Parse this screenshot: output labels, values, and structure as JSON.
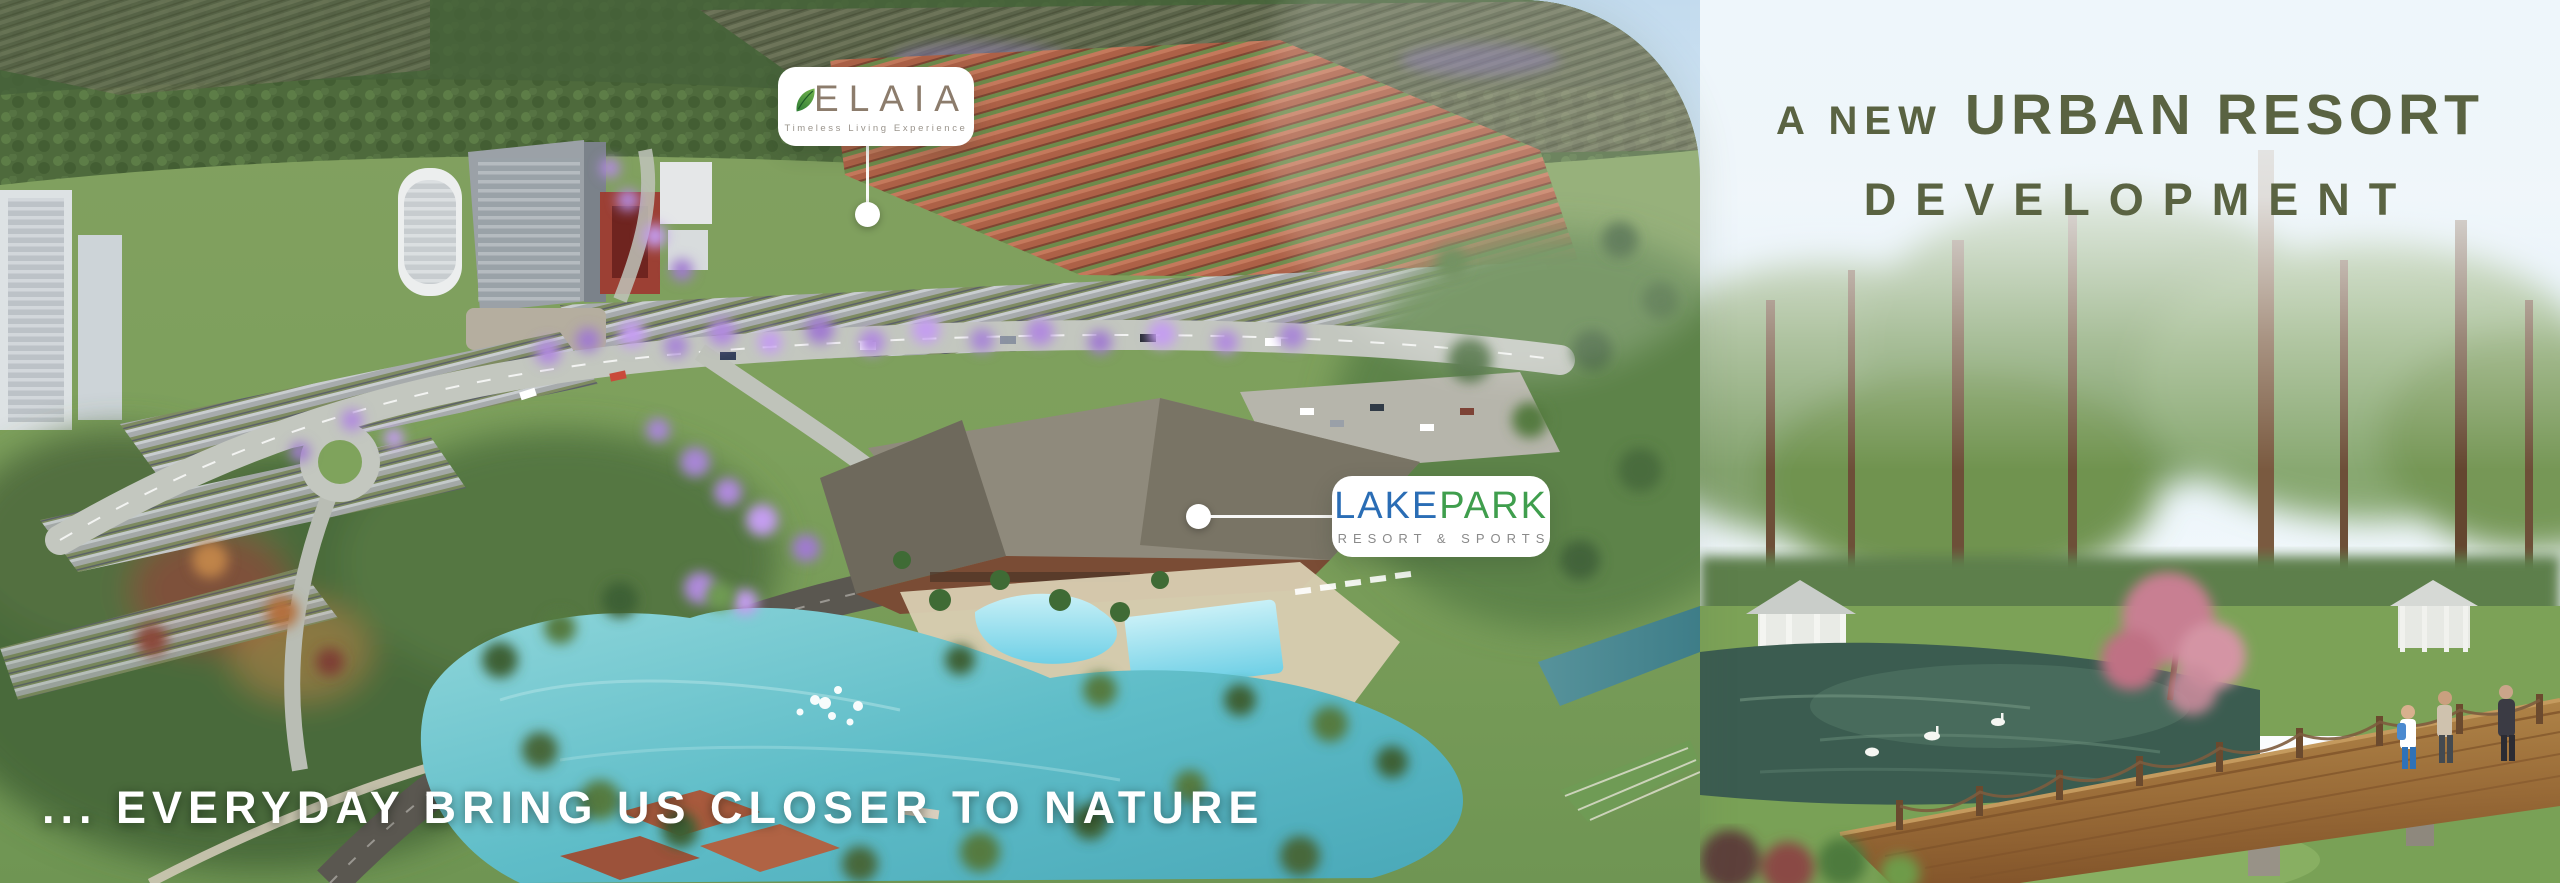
{
  "banner": {
    "headline": {
      "prefix": "A NEW",
      "emphasis": "URBAN RESORT",
      "line2": "DEVELOPMENT"
    },
    "bottom_tagline": "... EVERYDAY BRING US CLOSER TO NATURE"
  },
  "badges": {
    "elaia": {
      "brand": "ELAIA",
      "tagline": "Timeless Living Experience"
    },
    "lakepark": {
      "part1": "LAKE",
      "part2": "PARK",
      "subtitle": "RESORT & SPORTS"
    }
  },
  "icons": {
    "leaf": "leaf-icon",
    "elaia_callout_dot": "callout-dot",
    "lakepark_callout_dot": "callout-dot"
  },
  "colors": {
    "headline_olive": "#5a6342",
    "tagline_white": "#ffffff",
    "elaia_taupe": "#8c7c6c",
    "leaf_green": "#3e8a3e",
    "lake_blue": "#2a6db5",
    "park_green": "#3f9e4d",
    "resort_sports_gray": "#8a8a8a",
    "sky_top": "#c3dbee",
    "lake_turquoise": "#5fbdc8"
  }
}
